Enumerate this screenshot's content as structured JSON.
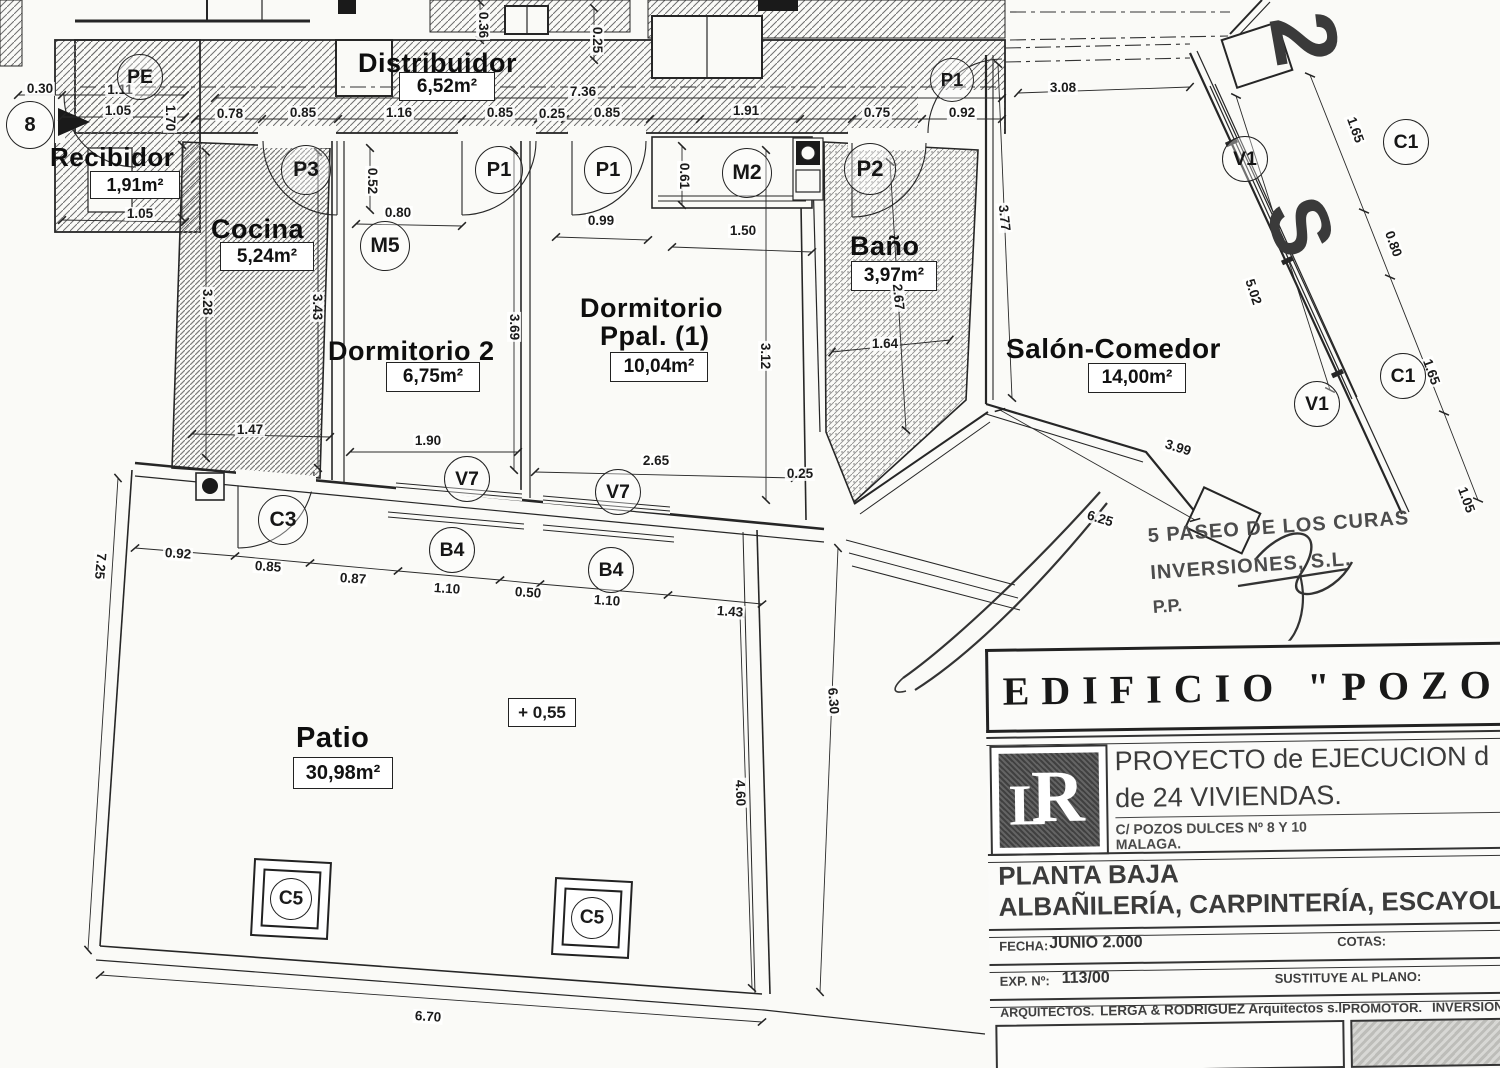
{
  "drawing": {
    "rooms": {
      "distribuidor": {
        "name": "Distribuidor",
        "area": "6,52m²"
      },
      "recibidor": {
        "name": "Recibidor",
        "area": "1,91m²"
      },
      "cocina": {
        "name": "Cocina",
        "area": "5,24m²"
      },
      "dormitorio2": {
        "name": "Dormitorio 2",
        "area": "6,75m²"
      },
      "dormitorio_ppal": {
        "name_line1": "Dormitorio",
        "name_line2": "Ppal. (1)",
        "area": "10,04m²"
      },
      "bano": {
        "name": "Baño",
        "area": "3,97m²"
      },
      "salon": {
        "name": "Salón-Comedor",
        "area": "14,00m²"
      },
      "patio": {
        "name": "Patio",
        "area": "30,98m²"
      }
    },
    "level_mark": "+ 0,55",
    "street": {
      "char1": "2",
      "char2": "S"
    },
    "stamp": {
      "line1": "5 PASEO DE LOS CURAS",
      "line2": "INVERSIONES, S.L.",
      "line3": "P.P."
    },
    "tags": [
      {
        "t": "PE",
        "x": 139,
        "y": 76,
        "d": 44
      },
      {
        "t": "P3",
        "x": 305,
        "y": 169,
        "d": 48
      },
      {
        "t": "M5",
        "x": 384,
        "y": 245,
        "d": 48
      },
      {
        "t": "P1",
        "x": 498,
        "y": 169,
        "d": 46
      },
      {
        "t": "P1",
        "x": 607,
        "y": 169,
        "d": 46
      },
      {
        "t": "M2",
        "x": 746,
        "y": 172,
        "d": 48
      },
      {
        "t": "P2",
        "x": 869,
        "y": 168,
        "d": 50
      },
      {
        "t": "P1",
        "x": 951,
        "y": 79,
        "d": 42
      },
      {
        "t": "C3",
        "x": 282,
        "y": 519,
        "d": 48
      },
      {
        "t": "V7",
        "x": 466,
        "y": 478,
        "d": 44
      },
      {
        "t": "V7",
        "x": 617,
        "y": 491,
        "d": 44
      },
      {
        "t": "B4",
        "x": 451,
        "y": 549,
        "d": 44
      },
      {
        "t": "B4",
        "x": 610,
        "y": 569,
        "d": 44
      },
      {
        "t": "C5",
        "x": 289,
        "y": 897,
        "d": 40,
        "sq": true
      },
      {
        "t": "C5",
        "x": 590,
        "y": 916,
        "d": 40,
        "sq": true
      },
      {
        "t": "V1",
        "x": 1244,
        "y": 158,
        "d": 44
      },
      {
        "t": "V1",
        "x": 1316,
        "y": 403,
        "d": 44
      },
      {
        "t": "C1",
        "x": 1405,
        "y": 141,
        "d": 44
      },
      {
        "t": "C1",
        "x": 1402,
        "y": 375,
        "d": 44
      },
      {
        "t": "8",
        "x": 29,
        "y": 124,
        "d": 46
      }
    ],
    "dims": [
      {
        "t": "0.30",
        "x": 40,
        "y": 89
      },
      {
        "t": "1.11",
        "x": 120,
        "y": 90
      },
      {
        "t": "1.05",
        "x": 118,
        "y": 111
      },
      {
        "t": "1.70",
        "x": 170,
        "y": 118,
        "r": 90
      },
      {
        "t": "0.78",
        "x": 230,
        "y": 114
      },
      {
        "t": "0.85",
        "x": 303,
        "y": 113
      },
      {
        "t": "1.16",
        "x": 399,
        "y": 113
      },
      {
        "t": "0.85",
        "x": 500,
        "y": 113
      },
      {
        "t": "0.25",
        "x": 552,
        "y": 114
      },
      {
        "t": "0.85",
        "x": 607,
        "y": 113
      },
      {
        "t": "7.36",
        "x": 583,
        "y": 92
      },
      {
        "t": "1.91",
        "x": 746,
        "y": 111
      },
      {
        "t": "0.75",
        "x": 877,
        "y": 113
      },
      {
        "t": "0.92",
        "x": 962,
        "y": 113
      },
      {
        "t": "3.08",
        "x": 1063,
        "y": 88
      },
      {
        "t": "1.05",
        "x": 140,
        "y": 214
      },
      {
        "t": "0.52",
        "x": 372,
        "y": 181,
        "r": 90
      },
      {
        "t": "0.80",
        "x": 398,
        "y": 213
      },
      {
        "t": "0.99",
        "x": 601,
        "y": 221
      },
      {
        "t": "1.50",
        "x": 743,
        "y": 231
      },
      {
        "t": "0.61",
        "x": 684,
        "y": 176,
        "r": 90
      },
      {
        "t": "3.28",
        "x": 207,
        "y": 302,
        "r": 90
      },
      {
        "t": "3.43",
        "x": 317,
        "y": 307,
        "r": 90
      },
      {
        "t": "3.69",
        "x": 514,
        "y": 327,
        "r": 90
      },
      {
        "t": "3.12",
        "x": 765,
        "y": 356,
        "r": 90
      },
      {
        "t": "1.47",
        "x": 250,
        "y": 430
      },
      {
        "t": "1.90",
        "x": 428,
        "y": 441
      },
      {
        "t": "2.65",
        "x": 656,
        "y": 461
      },
      {
        "t": "0.25",
        "x": 800,
        "y": 474
      },
      {
        "t": "1.64",
        "x": 885,
        "y": 344
      },
      {
        "t": "2.67",
        "x": 898,
        "y": 297,
        "r": 84
      },
      {
        "t": "3.77",
        "x": 1004,
        "y": 218,
        "r": 84
      },
      {
        "t": "5.02",
        "x": 1253,
        "y": 292,
        "r": 72
      },
      {
        "t": "1.65",
        "x": 1355,
        "y": 130,
        "r": 70
      },
      {
        "t": "0.80",
        "x": 1393,
        "y": 244,
        "r": 70
      },
      {
        "t": "1.65",
        "x": 1431,
        "y": 372,
        "r": 70
      },
      {
        "t": "1.05",
        "x": 1466,
        "y": 500,
        "r": 70
      },
      {
        "t": "3.99",
        "x": 1178,
        "y": 448,
        "r": 17
      },
      {
        "t": "6.25",
        "x": 1100,
        "y": 519,
        "r": 17
      },
      {
        "t": "0.92",
        "x": 178,
        "y": 554,
        "r": 4
      },
      {
        "t": "0.85",
        "x": 268,
        "y": 567,
        "r": 4
      },
      {
        "t": "0.87",
        "x": 353,
        "y": 579,
        "r": 4
      },
      {
        "t": "1.10",
        "x": 447,
        "y": 589,
        "r": 4
      },
      {
        "t": "0.50",
        "x": 528,
        "y": 593,
        "r": 4
      },
      {
        "t": "1.10",
        "x": 607,
        "y": 601,
        "r": 4
      },
      {
        "t": "1.43",
        "x": 730,
        "y": 612,
        "r": 4
      },
      {
        "t": "7.25",
        "x": 100,
        "y": 566,
        "r": 95
      },
      {
        "t": "4.60",
        "x": 740,
        "y": 793,
        "r": 88
      },
      {
        "t": "6.30",
        "x": 833,
        "y": 701,
        "r": 86
      },
      {
        "t": "6.70",
        "x": 428,
        "y": 1017,
        "r": 4
      },
      {
        "t": "0.36",
        "x": 483,
        "y": 25,
        "r": 90
      },
      {
        "t": "0.25",
        "x": 597,
        "y": 40,
        "r": 90
      }
    ]
  },
  "titleblock": {
    "project_title": "EDIFICIO \"POZOS",
    "logo_letter_l": "L",
    "logo_letter_r": "R",
    "project_line1": "PROYECTO de EJECUCION d",
    "project_line2": "de 24 VIVIENDAS.",
    "address_line1": "C/ POZOS DULCES Nº 8 Y 10",
    "address_line2": "MALAGA.",
    "sheet_name": "PLANTA BAJA",
    "sheet_subtitle": "ALBAÑILERÍA, CARPINTERÍA, ESCAYOLA",
    "fecha_label": "FECHA:",
    "fecha_value": "JUNIO 2.000",
    "cotas_label": "COTAS:",
    "exp_label": "EXP. Nº:",
    "exp_value": "113/00",
    "sustituye_label": "SUSTITUYE AL PLANO:",
    "arquitectos_label": "ARQUITECTOS.",
    "arquitectos_value": "LERGA & RODRIGUEZ Arquitectos s.l.",
    "promotor_label": "PROMOTOR.",
    "promotor_value": "INVERSIONE"
  }
}
